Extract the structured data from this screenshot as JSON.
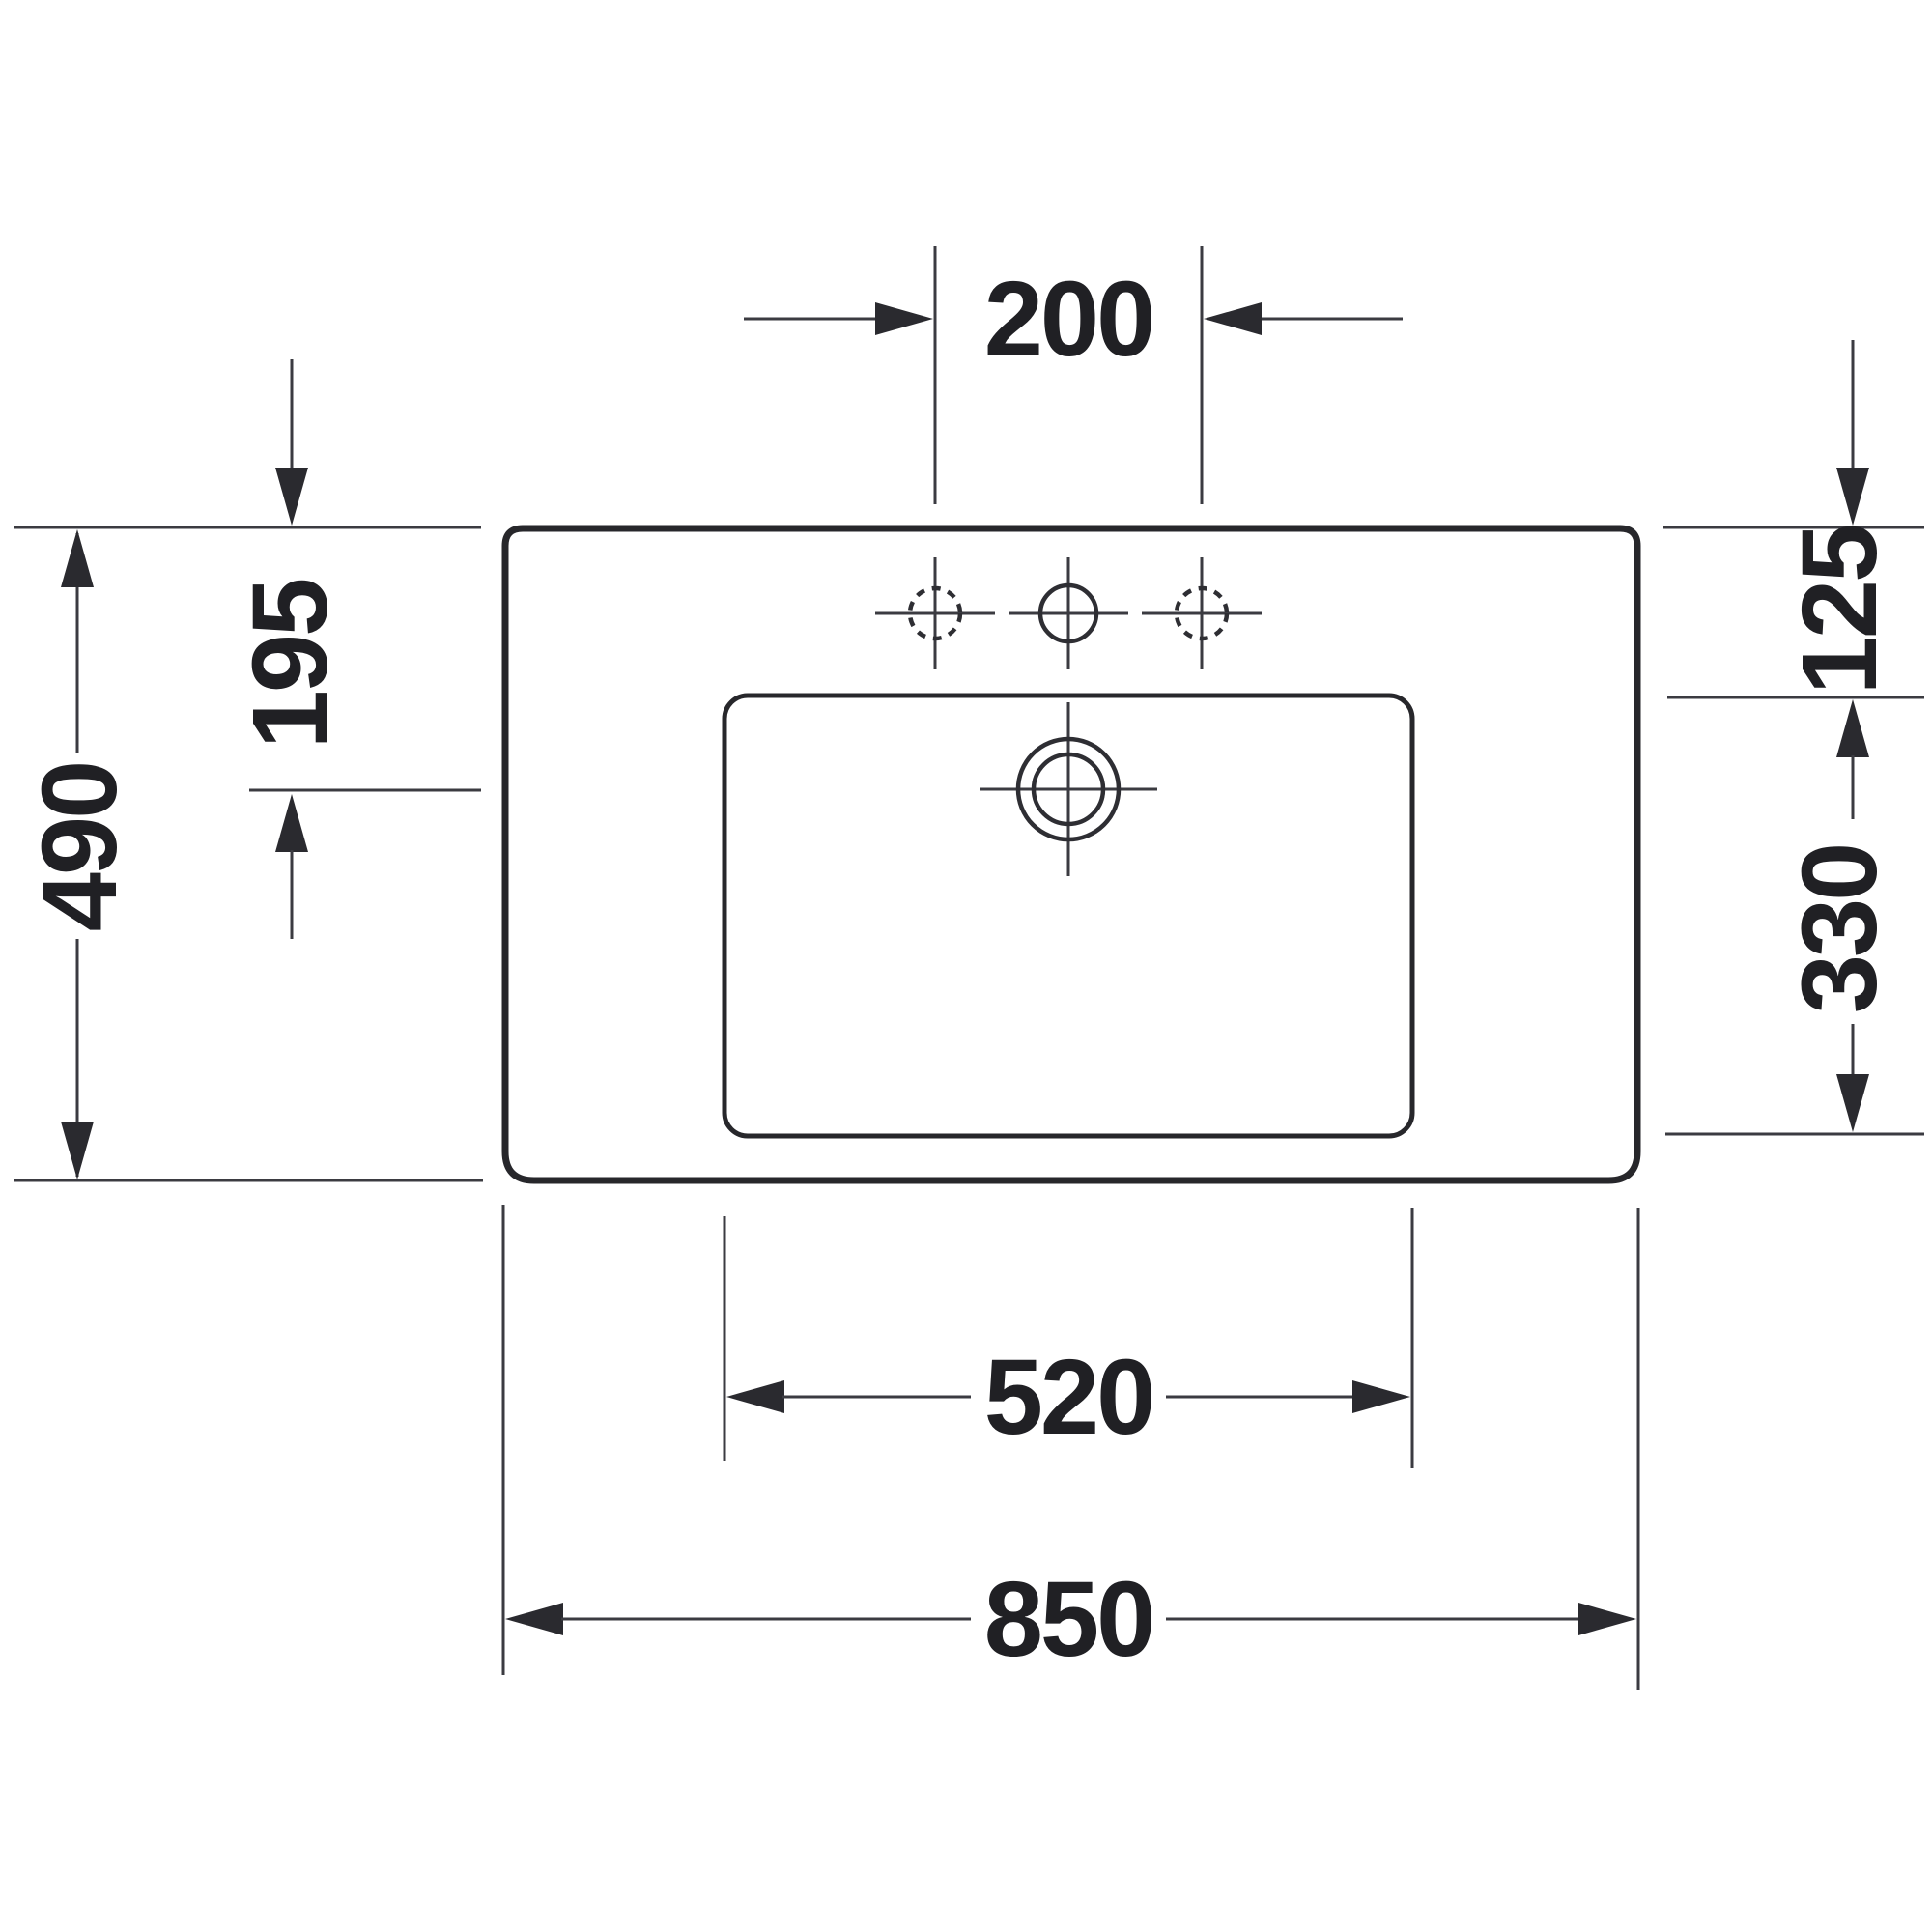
{
  "drawing": {
    "subject": "washbasin-top-view-dimension-drawing",
    "colors": {
      "background": "#ffffff",
      "outline": "#27272b",
      "dimension_lines": "#3b3b41",
      "text": "#202024"
    },
    "dimensions": {
      "faucet_hole_spacing": "200",
      "overall_depth": "490",
      "back_edge_to_drain_center": "195",
      "back_edge_to_basin_rim": "125",
      "basin_inner_depth": "330",
      "basin_inner_width": "520",
      "overall_width": "850"
    }
  }
}
